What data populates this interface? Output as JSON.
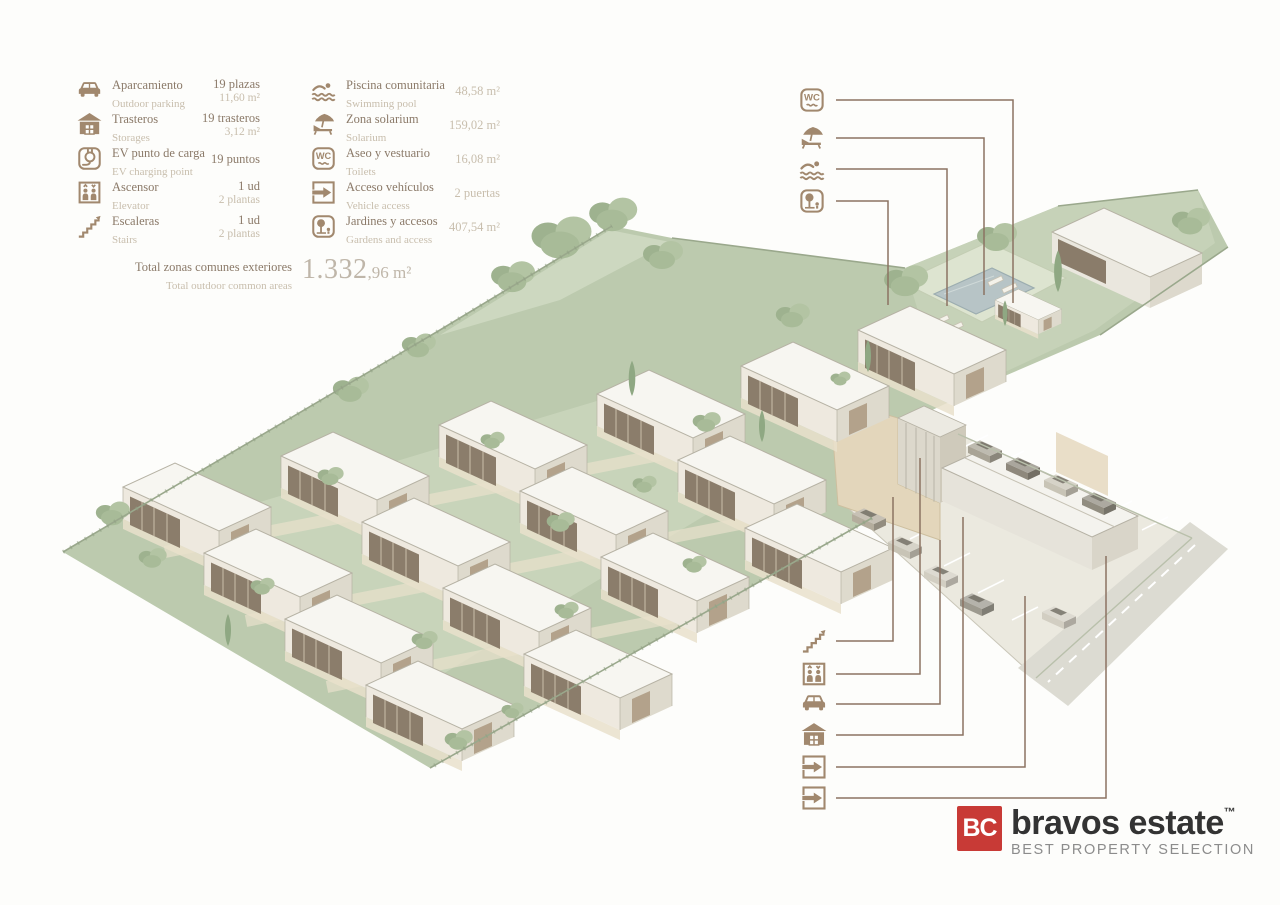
{
  "legend": {
    "left": [
      {
        "name": "parking",
        "es": "Aparcamiento",
        "en": "Outdoor parking",
        "value": "19 plazas",
        "value2": "11,60 m²"
      },
      {
        "name": "storages",
        "es": "Trasteros",
        "en": "Storages",
        "value": "19 trasteros",
        "value2": "3,12 m²"
      },
      {
        "name": "ev-charging",
        "es": "EV punto de carga",
        "en": "EV charging point",
        "value": "19 puntos",
        "value2": ""
      },
      {
        "name": "elevator",
        "es": "Ascensor",
        "en": "Elevator",
        "value": "1 ud",
        "value2": "2 plantas"
      },
      {
        "name": "stairs",
        "es": "Escaleras",
        "en": "Stairs",
        "value": "1 ud",
        "value2": "2 plantas"
      }
    ],
    "right": [
      {
        "name": "pool",
        "es": "Piscina comunitaria",
        "en": "Swimming pool",
        "value": "48,58 m²"
      },
      {
        "name": "solarium",
        "es": "Zona solarium",
        "en": "Solarium",
        "value": "159,02 m²"
      },
      {
        "name": "toilets",
        "es": "Aseo y vestuario",
        "en": "Toilets",
        "value": "16,08 m²"
      },
      {
        "name": "vehicle-access",
        "es": "Acceso vehículos",
        "en": "Vehicle access",
        "value": "2 puertas"
      },
      {
        "name": "gardens",
        "es": "Jardines y accesos",
        "en": "Gardens and access",
        "value": "407,54 m²"
      }
    ],
    "total": {
      "es": "Total zonas comunes exteriores",
      "en": "Total outdoor common areas",
      "value_main": "1.332",
      "value_unit": ",96 m²"
    }
  },
  "callouts": {
    "top": [
      "toilets",
      "solarium",
      "swimming-pool",
      "gardens"
    ],
    "bottom": [
      "stairs",
      "elevator",
      "parking",
      "storages",
      "vehicle-access",
      "vehicle-access"
    ]
  },
  "logo": {
    "monogram": "BC",
    "name": "bravos estate",
    "trademark": "™",
    "tagline": "BEST PROPERTY SELECTION"
  },
  "colors": {
    "accent_brown": "#a1886e",
    "leader_line": "#8b7362",
    "terrain_green": "#bccaae",
    "logo_red": "#c83a36",
    "pool_blue": "#b7c4c6"
  }
}
